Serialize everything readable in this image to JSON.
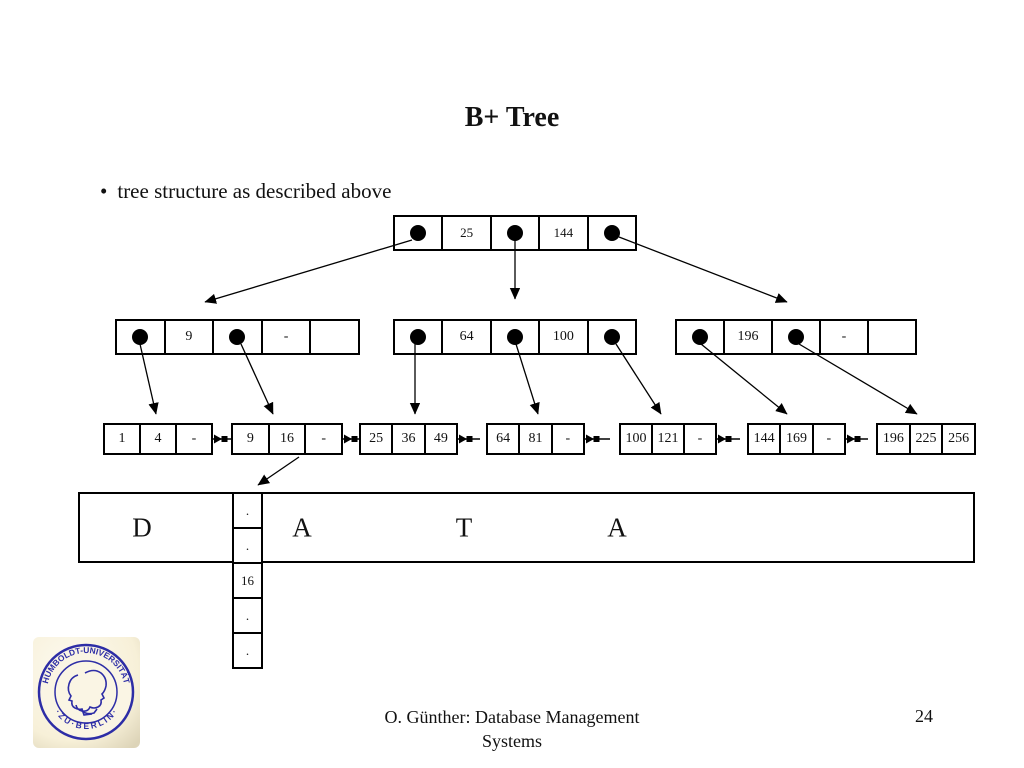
{
  "slide": {
    "title": "B+ Tree",
    "bullet_marker": "•",
    "bullet": "tree structure as described above",
    "footer_line1": "O. Günther: Database Management",
    "footer_line2": "Systems",
    "page_number": "24"
  },
  "tree": {
    "root_keys": [
      "25",
      "144"
    ],
    "internal": [
      {
        "keys": [
          "9",
          "-"
        ]
      },
      {
        "keys": [
          "64",
          "100"
        ]
      },
      {
        "keys": [
          "196",
          "-"
        ]
      }
    ],
    "leaves": [
      [
        "1",
        "4",
        "-"
      ],
      [
        "9",
        "16",
        "-"
      ],
      [
        "25",
        "36",
        "49"
      ],
      [
        "64",
        "81",
        "-"
      ],
      [
        "100",
        "121",
        "-"
      ],
      [
        "144",
        "169",
        "-"
      ],
      [
        "196",
        "225",
        "256"
      ]
    ],
    "data_letters": [
      "D",
      "A",
      "T",
      "A"
    ],
    "column_cells": [
      ".",
      ".",
      "16",
      ".",
      "."
    ]
  },
  "logo": {
    "text_top": "HUMBOLDT-UNIVERSITÄT",
    "text_bottom": "· Z U · B E R L I N ·",
    "seal_color": "#2d2da6",
    "bg_color": "#fbf6e2"
  }
}
